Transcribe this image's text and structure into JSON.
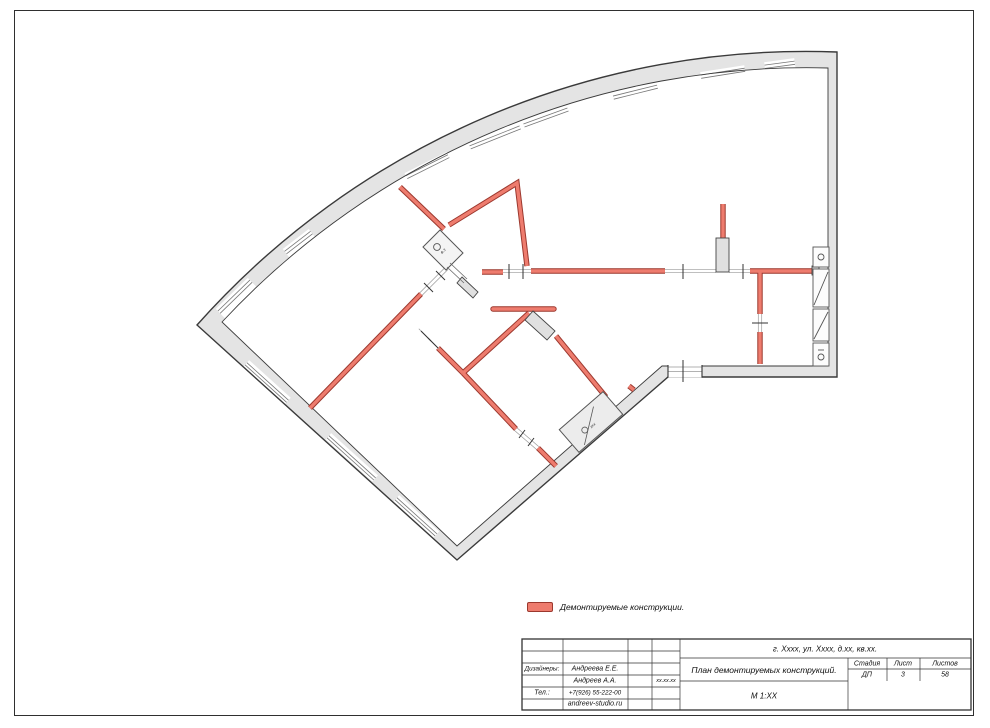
{
  "sheet": {
    "background": "#ffffff",
    "frame_color": "#2f2f2f"
  },
  "plan": {
    "wall_fill": "#e4e4e4",
    "wall_outline": "#3a3a3a",
    "demolition_fill": "#ee7c6e",
    "demolition_outline": "#9c382e",
    "shaft_label": "в.з",
    "entry_label": "xxx"
  },
  "legend": {
    "label": "Демонтируемые конструкции."
  },
  "title_block": {
    "address": "г. Хххх, ул. Хххх, д.хх, кв.хх.",
    "designers_label": "Дизайнеры:",
    "designer_1": "Андреева Е.Е.",
    "designer_2": "Андреев А.А.",
    "date": "xx.xx.xx",
    "phone_label": "Тел.:",
    "phone": "+7(926) 55-222-00",
    "website": "andreev-studio.ru",
    "drawing_title": "План демонтируемых конструкций.",
    "scale": "М  1:ХХ",
    "stage_label": "Стадия",
    "sheet_label": "Лист",
    "sheets_label": "Листов",
    "stage": "ДП",
    "sheet": "3",
    "sheets": "58"
  }
}
